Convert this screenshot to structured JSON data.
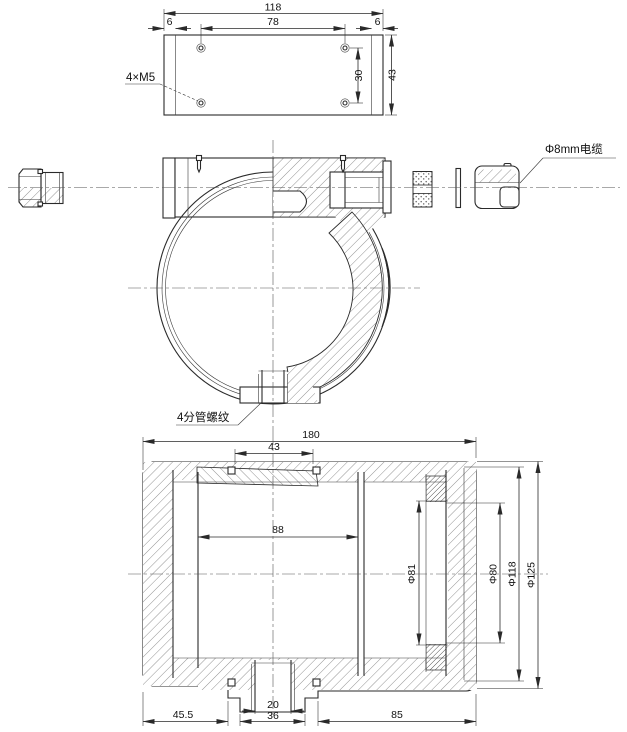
{
  "colors": {
    "ink": "#2a2a2a",
    "background": "#ffffff"
  },
  "top_view": {
    "dim_overall_width": "118",
    "dim_hole_pitch_h": "78",
    "dim_edge_left": "6",
    "dim_edge_right": "6",
    "dim_overall_height": "43",
    "dim_hole_pitch_v": "30",
    "label_holes": "4×M5"
  },
  "front_view": {
    "label_cable": "Φ8mm电缆",
    "label_pipe_thread": "4分管螺纹"
  },
  "section_view": {
    "dim_overall_length": "180",
    "dim_top_slot": "43",
    "dim_inner_cavity": "88",
    "dim_left_step": "45.5",
    "dim_boss_bore": "20",
    "dim_boss_width": "36",
    "dim_right_span": "85",
    "dim_dia_81": "Φ81",
    "dim_dia_80": "Φ80",
    "dim_dia_118": "Φ118",
    "dim_dia_125": "Φ125"
  }
}
